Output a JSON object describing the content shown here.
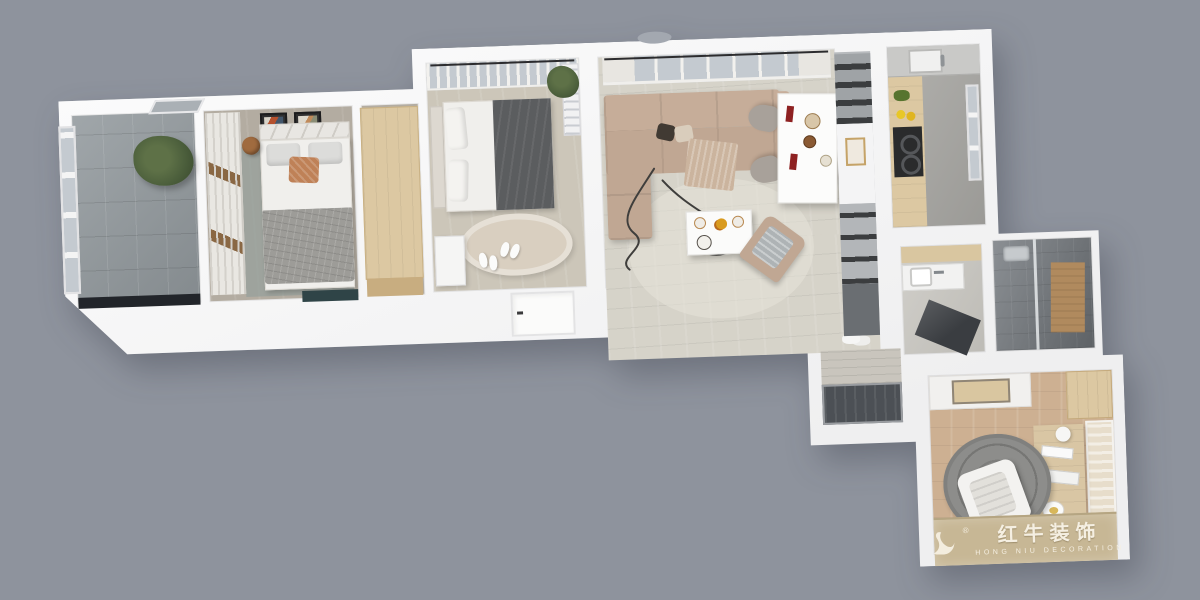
{
  "watermark": {
    "brand_cn": "红牛装饰",
    "brand_en": "HONG NIU DECORATION",
    "registered": "®"
  },
  "colors": {
    "bg": "#8e939d",
    "wall": "#f7f7f8",
    "wall_shade": "#e7e7ea",
    "floor_wood_light": "#d6d3c9",
    "floor_wood_warm": "#cdb092",
    "floor_tile_gray": "#939a9e",
    "floor_bedroom": "#b3aca1",
    "floor_bedroom2": "#ccc6b9",
    "floor_kitchen": "#a8a7a3",
    "floor_vanity": "#c9c7c1",
    "shower_dark": "#787d82",
    "sofa_taupe": "#c0a793",
    "bed_white": "#f0efec",
    "blanket_gray": "#9d9c98",
    "blanket_dark": "#5b5d5f",
    "pillow_rust": "#bf8157",
    "wood_tan": "#dcc8a2",
    "wood_tan_face": "#c8ad80",
    "cabinet_gray": "#b7babd",
    "slot_dark": "#3b3d3f",
    "door_dark": "#4c5055",
    "accent_red": "#8e2121",
    "plant_green": "#4c5f3c",
    "glass_blue": "#c4cad0",
    "curtain": "#e8e6e1",
    "rug_gray": "#8d8d8b",
    "rug_beige": "#d9cfc0",
    "watermark_bg": "#c7b795",
    "watermark_text": "#f5efe2",
    "black_ledge": "#22252a"
  }
}
